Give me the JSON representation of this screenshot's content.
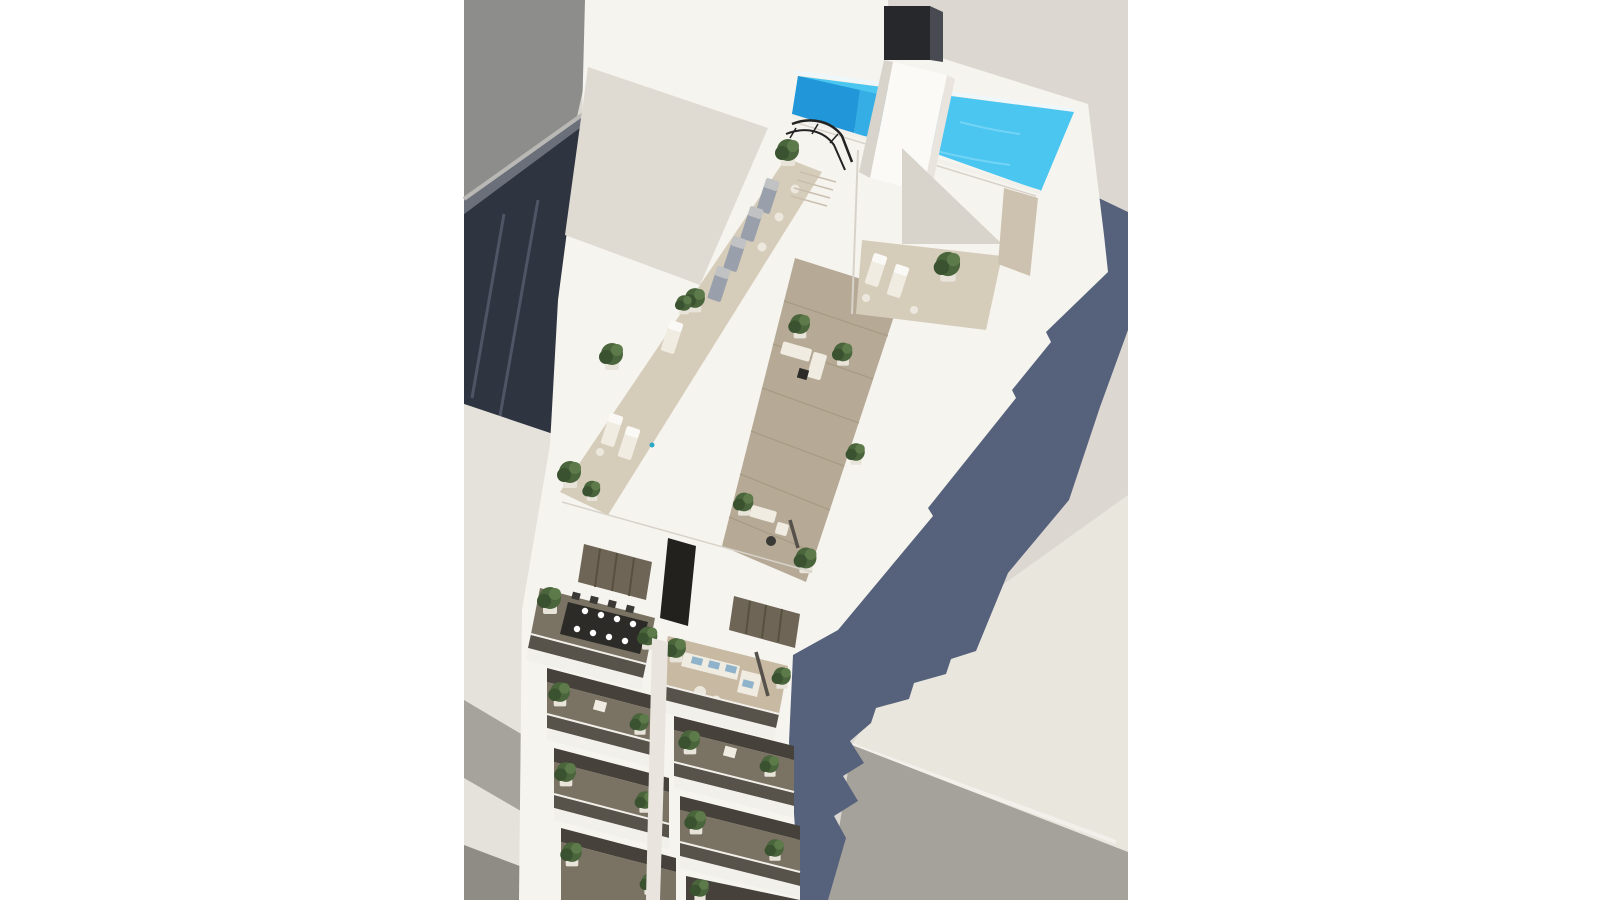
{
  "meta": {
    "title": "Aerial architectural rendering",
    "description": "Aerial 3D architectural rendering of a modern white apartment tower seen from above, with a rooftop swimming pool, sun decks, potted plants, penthouse terraces and stacked balconies, casting a long blue-grey shadow over neighbouring rooftops and the street.",
    "aria_label": "3D aerial rendering of white apartment building with rooftop pool and terraces"
  },
  "scene": {
    "background": "white page with centered render on warm light-grey ground",
    "objects": {
      "neighbor-roof": "grey pitched roof of adjacent building, top left",
      "street": "dark asphalt street with lane lines running diagonally, left",
      "pavement": "light pavement with grey diagonal stripes, bottom left",
      "main-building": "tall white apartment building viewed from above at an angle",
      "rooftop-pool": "L-shaped swimming pool in two tones of blue along the top roof edge",
      "chimney": "dark rooftop chimney / vent stack",
      "stair-core": "white stair and elevator core crossing the pool deck",
      "stair-railing": "black curved staircase railing on the pool deck",
      "roof-courtyard": "recessed light-well courtyard with two loungers and a plant",
      "west-terrace": "long sun deck with row of grey loungers, side tables and potted plants",
      "wood-terrace": "wooden plank terrace with two white lounge suites and plants",
      "penthouse-doors": "louvered sliding doors of the penthouse level",
      "dining-balcony": "penthouse balcony with black dining table, chairs and white plates",
      "sofa-balcony": "penthouse balcony with white sofa, blue cushions, round tables and parasol",
      "balcony-stack": "two columns of stacked balconies with glass railings, white slabs and green plants",
      "cast-shadow": "long slate-blue shadow cast by the tower onto ground and lower roofs",
      "lower-building": "flat-roofed lower neighbouring building, bottom right"
    },
    "counts": {
      "balcony-levels-per-column": 4,
      "grey-loungers-west-terrace": 4,
      "courtyard-loungers": 2,
      "dining-plates": 8
    }
  },
  "colors": {
    "page_bg": "#ffffff",
    "ground": "#dcd8d1",
    "ground_lit": "#e9e6dd",
    "neighbor_roof": "#8d8d8b",
    "neighbor_eave": "#b9b8b5",
    "neighbor_fascia": "#6a6f79",
    "street": "#2e3440",
    "street_line": "#4e5565",
    "pavement": "#e5e2db",
    "pavement_stripe": "#a6a39c",
    "pavement_dark": "#8f8c85",
    "shadow": "#56627c",
    "wall_lit": "#f6f4ef",
    "wall_bright": "#fbfaf7",
    "wall_mid": "#e9e5de",
    "wall_greige": "#dfdbd3",
    "wall_shade": "#d9d4cb",
    "parapet_line": "#d8d3ca",
    "pool_light": "#4ac6f1",
    "pool_mid": "#35aee6",
    "pool_dark": "#2196d8",
    "pool_edge": "#eef8fc",
    "pool_ripple": "#7dd7f5",
    "deck": "#d6ccba",
    "deck_shade": "#ccc2af",
    "wood": "#b6aa96",
    "wood_line": "#a3977f",
    "step_line": "#cabfae",
    "chimney": "#26282c",
    "chimney_side": "#474a50",
    "railing": "#232323",
    "balcony_floor": "#7a7263",
    "balcony_sand": "#c8b9a3",
    "balcony_dark": "#46413a",
    "glass_band": "#57524a",
    "fascia": "#f2f0ea",
    "door": "#6e6557",
    "door_slat": "#57503f",
    "slit": "#23211e",
    "plant": "#4a653c",
    "plant_dark": "#3a5230",
    "plant_light": "#5d7a4a",
    "pot": "#e8e4da",
    "furniture_black": "#2c2b28",
    "furniture_dark": "#3a3935",
    "cushion_blue": "#8fb3ca",
    "lounger_slate": "#9aa0ab",
    "lounger_white": "#f0ece1",
    "table_white": "#ece8de",
    "parasol": "#56524b",
    "bottom_wall": "#a5a29b",
    "accent_teal": "#2aa8c8"
  }
}
